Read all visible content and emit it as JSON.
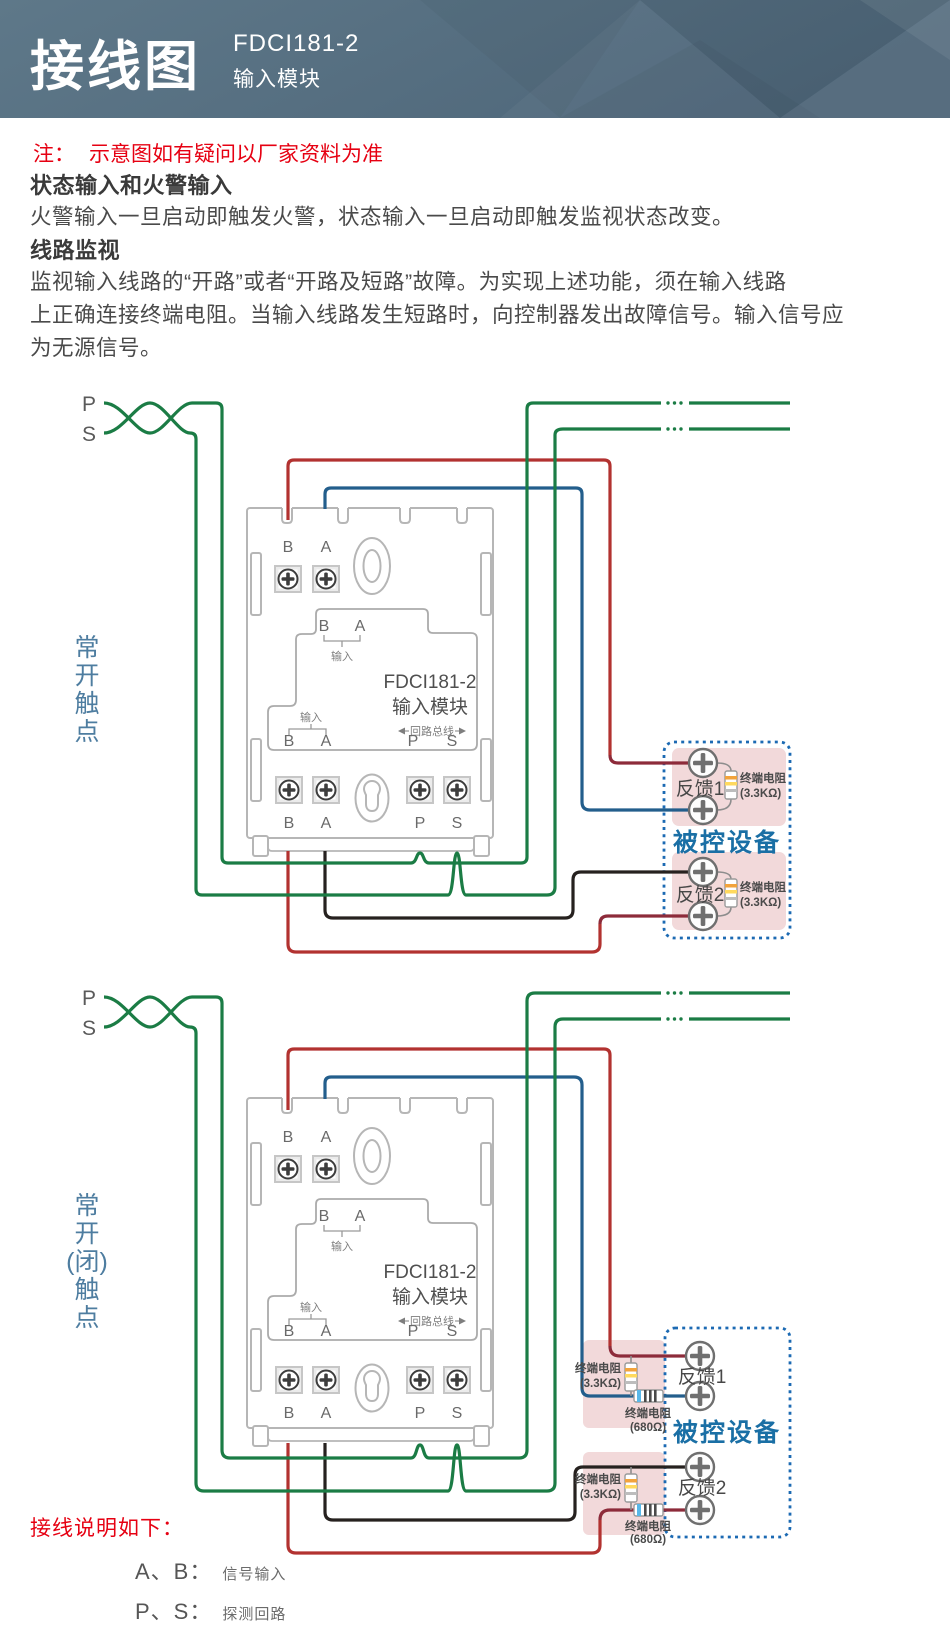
{
  "header": {
    "title": "接线图",
    "model": "FDCI181-2",
    "subtitle": "输入模块"
  },
  "note": {
    "label": "注：",
    "text": "示意图如有疑问以厂家资料为准"
  },
  "sections": [
    {
      "heading": "状态输入和火警输入",
      "lines": [
        "火警输入一旦启动即触发火警，状态输入一旦启动即触发监视状态改变。"
      ]
    },
    {
      "heading": "线路监视",
      "lines": [
        "监视输入线路的“开路”或者“开路及短路”故障。为实现上述功能，须在输入线路",
        "上正确连接终端电阻。当输入线路发生短路时，向控制器发出故障信号。输入信号应",
        "为无源信号。"
      ]
    }
  ],
  "loop": {
    "p": "P",
    "s": "S"
  },
  "module": {
    "model": "FDCI181-2",
    "name": "输入模块",
    "b": "B",
    "a": "A",
    "p": "P",
    "s": "S",
    "input": "输入",
    "bus": "回路总线"
  },
  "diagram1": {
    "label_chars": [
      "常",
      "开",
      "触",
      "点"
    ],
    "device": {
      "title": "被控设备",
      "fb1": "反馈1",
      "fb2": "反馈2",
      "res_name": "终端电阻",
      "res_value": "(3.3KΩ)"
    }
  },
  "diagram2": {
    "label_chars": [
      "常",
      "开",
      "(闭)",
      "触",
      "点"
    ],
    "device": {
      "title": "被控设备",
      "fb1": "反馈1",
      "fb2": "反馈2",
      "res33_name": "终端电阻",
      "res33_value": "(3.3KΩ)",
      "res680_name": "终端电阻",
      "res680_value": "(680Ω)"
    }
  },
  "legend": {
    "title": "接线说明如下：",
    "items": [
      {
        "term": "A、B：",
        "desc": "信号输入"
      },
      {
        "term": "P、S：",
        "desc": "探测回路"
      }
    ]
  },
  "colors": {
    "header_bg": "#587184",
    "note_red": "#e60012",
    "wire_green": "#1b7c45",
    "wire_red": "#b23230",
    "wire_dark_red": "#8d2b3a",
    "wire_blue": "#235e8c",
    "wire_black": "#26211f",
    "device_box_blue": "#1c6ab3",
    "device_text_blue": "#1a6fa5",
    "feedback_pink": "#f2d9da",
    "label_blue": "#4e7da0"
  }
}
